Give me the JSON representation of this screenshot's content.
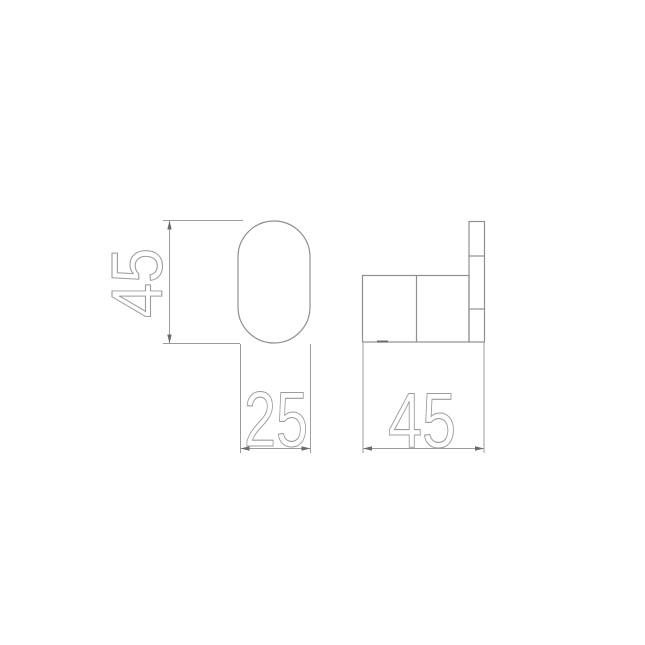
{
  "drawing": {
    "front_view": {
      "name": "front-view",
      "height_label": "45",
      "width_label": "25"
    },
    "side_view": {
      "name": "side-view",
      "depth_label": "45"
    }
  },
  "colors": {
    "background": "#ffffff",
    "object_line": "#8f8f8f",
    "dimension_line": "#9c9c9c",
    "dimension_text": "#9c9c9c",
    "arrow": "#6b6b6b"
  }
}
